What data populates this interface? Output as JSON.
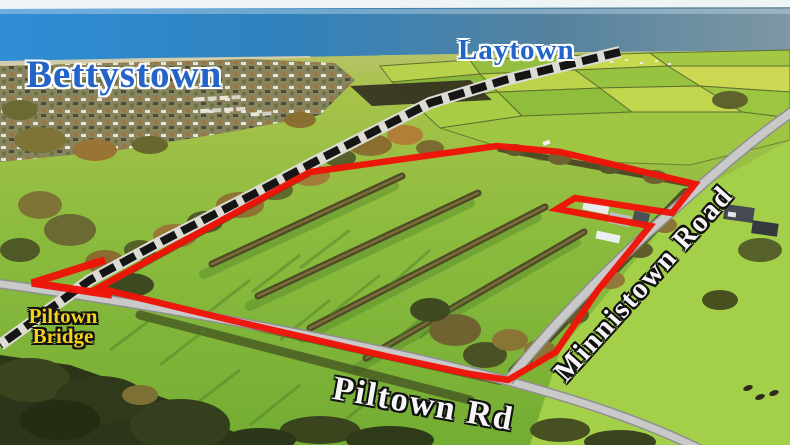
{
  "labels": {
    "town_left": "Bettystown",
    "town_right": "Laytown",
    "bridge_line1": "Piltown",
    "bridge_line2": "Bridge",
    "road_bottom": "Piltown Rd",
    "road_right": "Minnistown Road"
  },
  "colors": {
    "town_label_blue": "#2264c8",
    "bridge_label_yellow": "#f2d01e",
    "road_label_white": "#f6f6f6",
    "boundary_red": "#ee1408",
    "railway_black": "#151515",
    "railway_casing": "#dcdcd4",
    "road_grey": "#c9c9c9",
    "sea_blue": "#2f8ed6",
    "field_green": "#8cbc3e"
  },
  "overlay": {
    "boundary_points": "98,288 310,172 497,146 560,152 695,184 672,213 575,198 557,209 650,226 598,290 556,352 508,380 470,374 390,357 230,320",
    "arrow_points": "105,260 32,283 112,295",
    "railway_path": "M620,52 L505,80 L430,103 L320,159 L250,196 L155,245 L90,280 L0,345",
    "piltown_rd_path": "M-6,283 C120,300 340,336 508,381 C585,402 645,422 702,450",
    "minnistown_rd_path": "M508,381 C560,315 625,252 670,213 C705,182 745,145 792,112"
  }
}
